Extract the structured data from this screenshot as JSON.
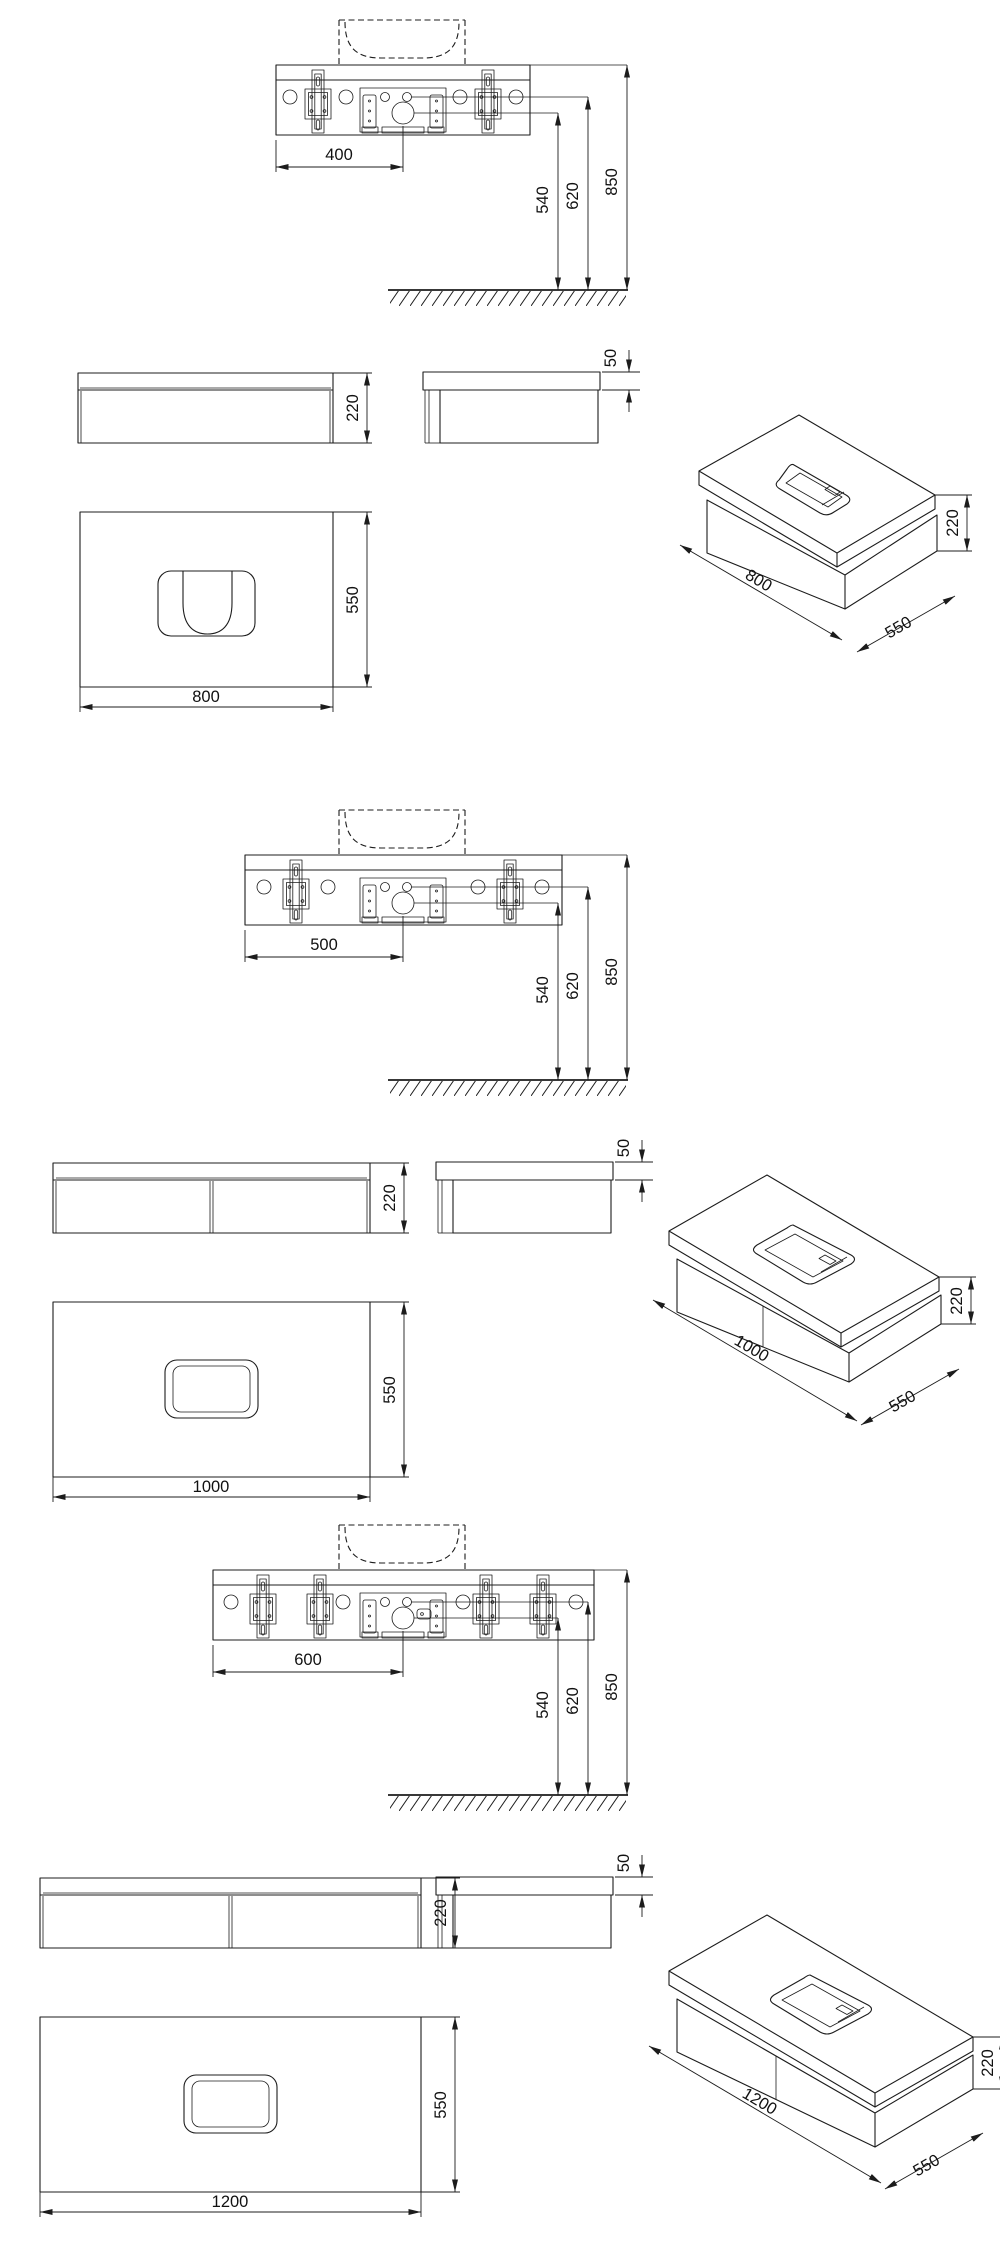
{
  "sheet": {
    "background": "#ffffff",
    "ink": "#1c1c1c"
  },
  "groups": [
    {
      "product": "wall-hung-vanity-800",
      "installation": {
        "center_offset": "400",
        "trap_height": "540",
        "outlet_height": "620",
        "mounting_height": "850"
      },
      "front_view": {
        "height": "220"
      },
      "side_view": {
        "worktop_thickness": "50"
      },
      "plan_view": {
        "depth": "550",
        "width": "800"
      },
      "isometric_view": {
        "width": "800",
        "depth": "550",
        "height": "220"
      }
    },
    {
      "product": "wall-hung-vanity-1000",
      "installation": {
        "center_offset": "500",
        "trap_height": "540",
        "outlet_height": "620",
        "mounting_height": "850"
      },
      "front_view": {
        "height": "220"
      },
      "side_view": {
        "worktop_thickness": "50"
      },
      "plan_view": {
        "depth": "550",
        "width": "1000"
      },
      "isometric_view": {
        "width": "1000",
        "depth": "550",
        "height": "220"
      }
    },
    {
      "product": "wall-hung-vanity-1200",
      "installation": {
        "center_offset": "600",
        "trap_height": "540",
        "outlet_height": "620",
        "mounting_height": "850"
      },
      "front_view": {
        "height": "220"
      },
      "side_view": {
        "worktop_thickness": "50"
      },
      "plan_view": {
        "depth": "550",
        "width": "1200"
      },
      "isometric_view": {
        "width": "1200",
        "depth": "550",
        "height": "220"
      }
    }
  ]
}
